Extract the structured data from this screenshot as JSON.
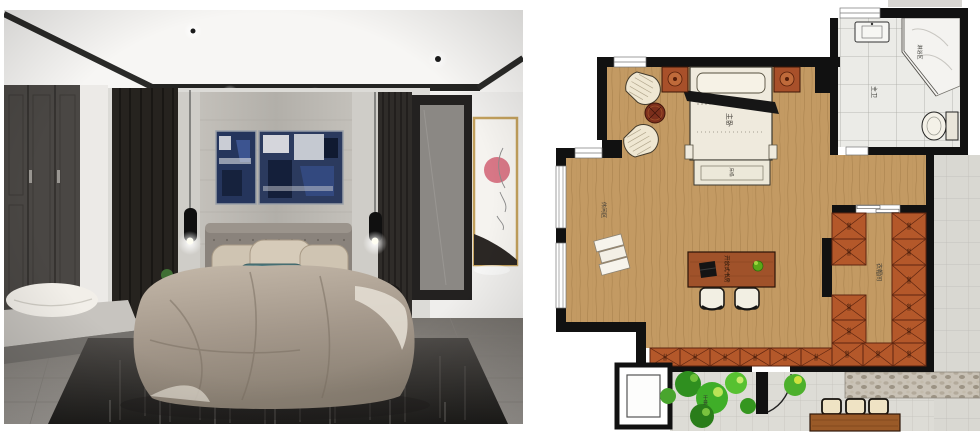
{
  "meta": {
    "canvas_width": 980,
    "canvas_height": 436
  },
  "left_photo": {
    "description": "bedroom-interior-render",
    "colors": {
      "curtain": "#26231f",
      "teal_pillow": "#4e7b80",
      "artwork_accent": "#d4697a",
      "duvet": "#a99c8e",
      "rug": "#35332f"
    }
  },
  "floor_plan": {
    "labels": {
      "master_bedroom": "主卧",
      "bed_bench": "床榻",
      "master_bathroom": "主卫",
      "shower_area": "淋浴区",
      "leisure_area": "休闲区",
      "open_study": "开放式书房",
      "walk_in_closet": "衣帽间",
      "wardrobe": "衣柜",
      "bookcase": "书柜",
      "dry_landscape": "干景"
    },
    "colors": {
      "wall": "#111111",
      "wood_floor": "#c39a63",
      "cabinet": "#b4582a",
      "bed_linen": "#efeadd",
      "desk_wood": "#a0522a",
      "tile": "#dddcd6",
      "corridor_tile": "#d9d8d2",
      "stone": "#c9c2b6",
      "plant_dark": "#2f8f1f",
      "plant_light": "#6fc13a"
    }
  }
}
